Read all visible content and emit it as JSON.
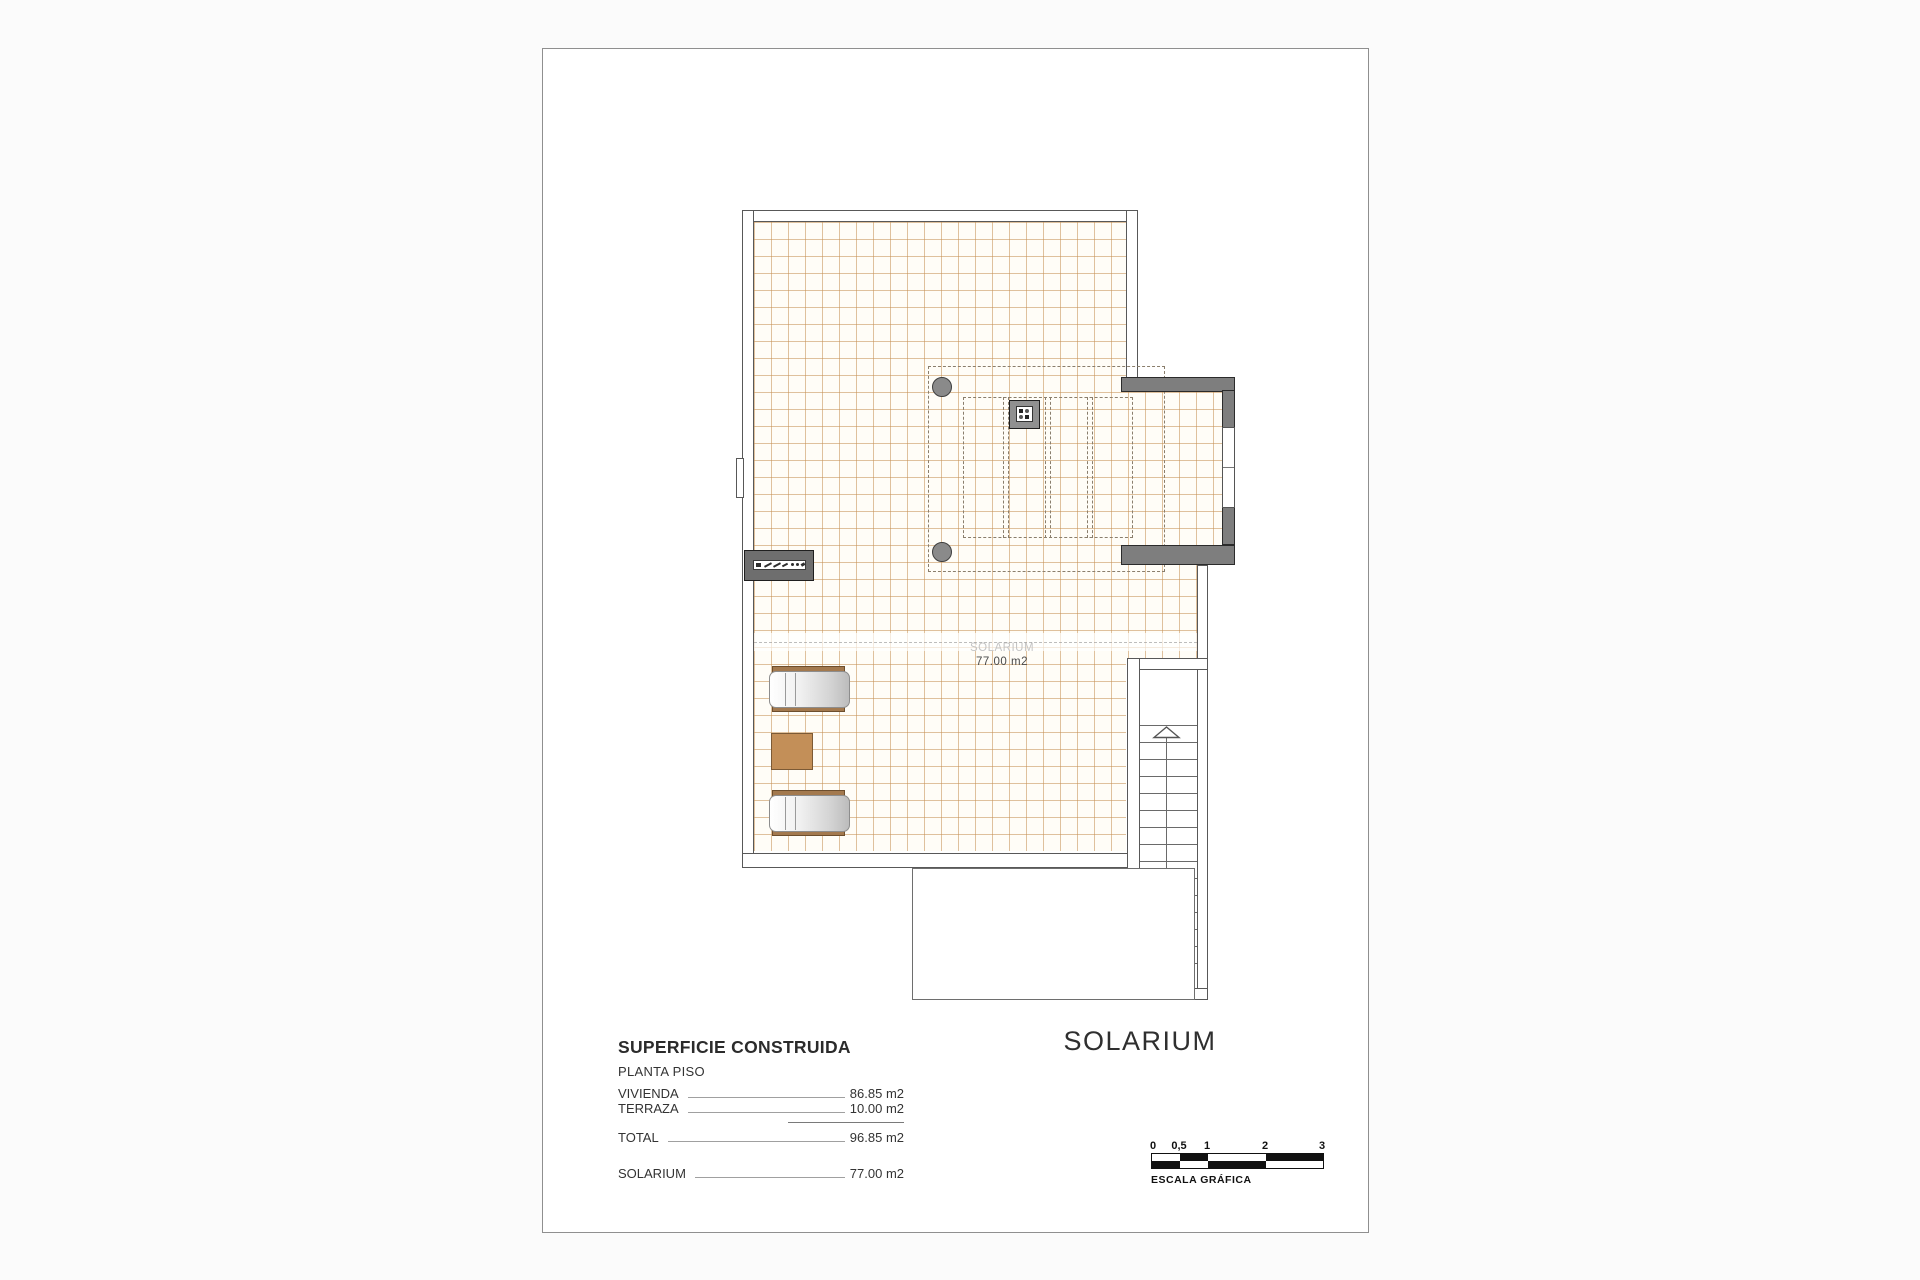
{
  "plan": {
    "room_label": {
      "name": "SOLARIUM",
      "area": "77.00 m2"
    },
    "title": "SOLARIUM"
  },
  "areas": {
    "title": "SUPERFICIE CONSTRUIDA",
    "subtitle": "PLANTA PISO",
    "rows": [
      {
        "label": "VIVIENDA",
        "value": "86.85 m2"
      },
      {
        "label": "TERRAZA",
        "value": "10.00 m2"
      },
      {
        "label": "TOTAL",
        "value": "96.85 m2"
      },
      {
        "label": "SOLARIUM",
        "value": "77.00 m2"
      }
    ]
  },
  "scale_bar": {
    "ticks": [
      "0",
      "0,5",
      "1",
      "2",
      "3"
    ],
    "caption": "ESCALA GRÁFICA"
  },
  "colors": {
    "grid_line": "#c59054",
    "wall_line": "#585858",
    "dark_wall_fill": "#7e7e7e",
    "wood": "#c38f58",
    "lounger_wood": "#a3794e"
  }
}
